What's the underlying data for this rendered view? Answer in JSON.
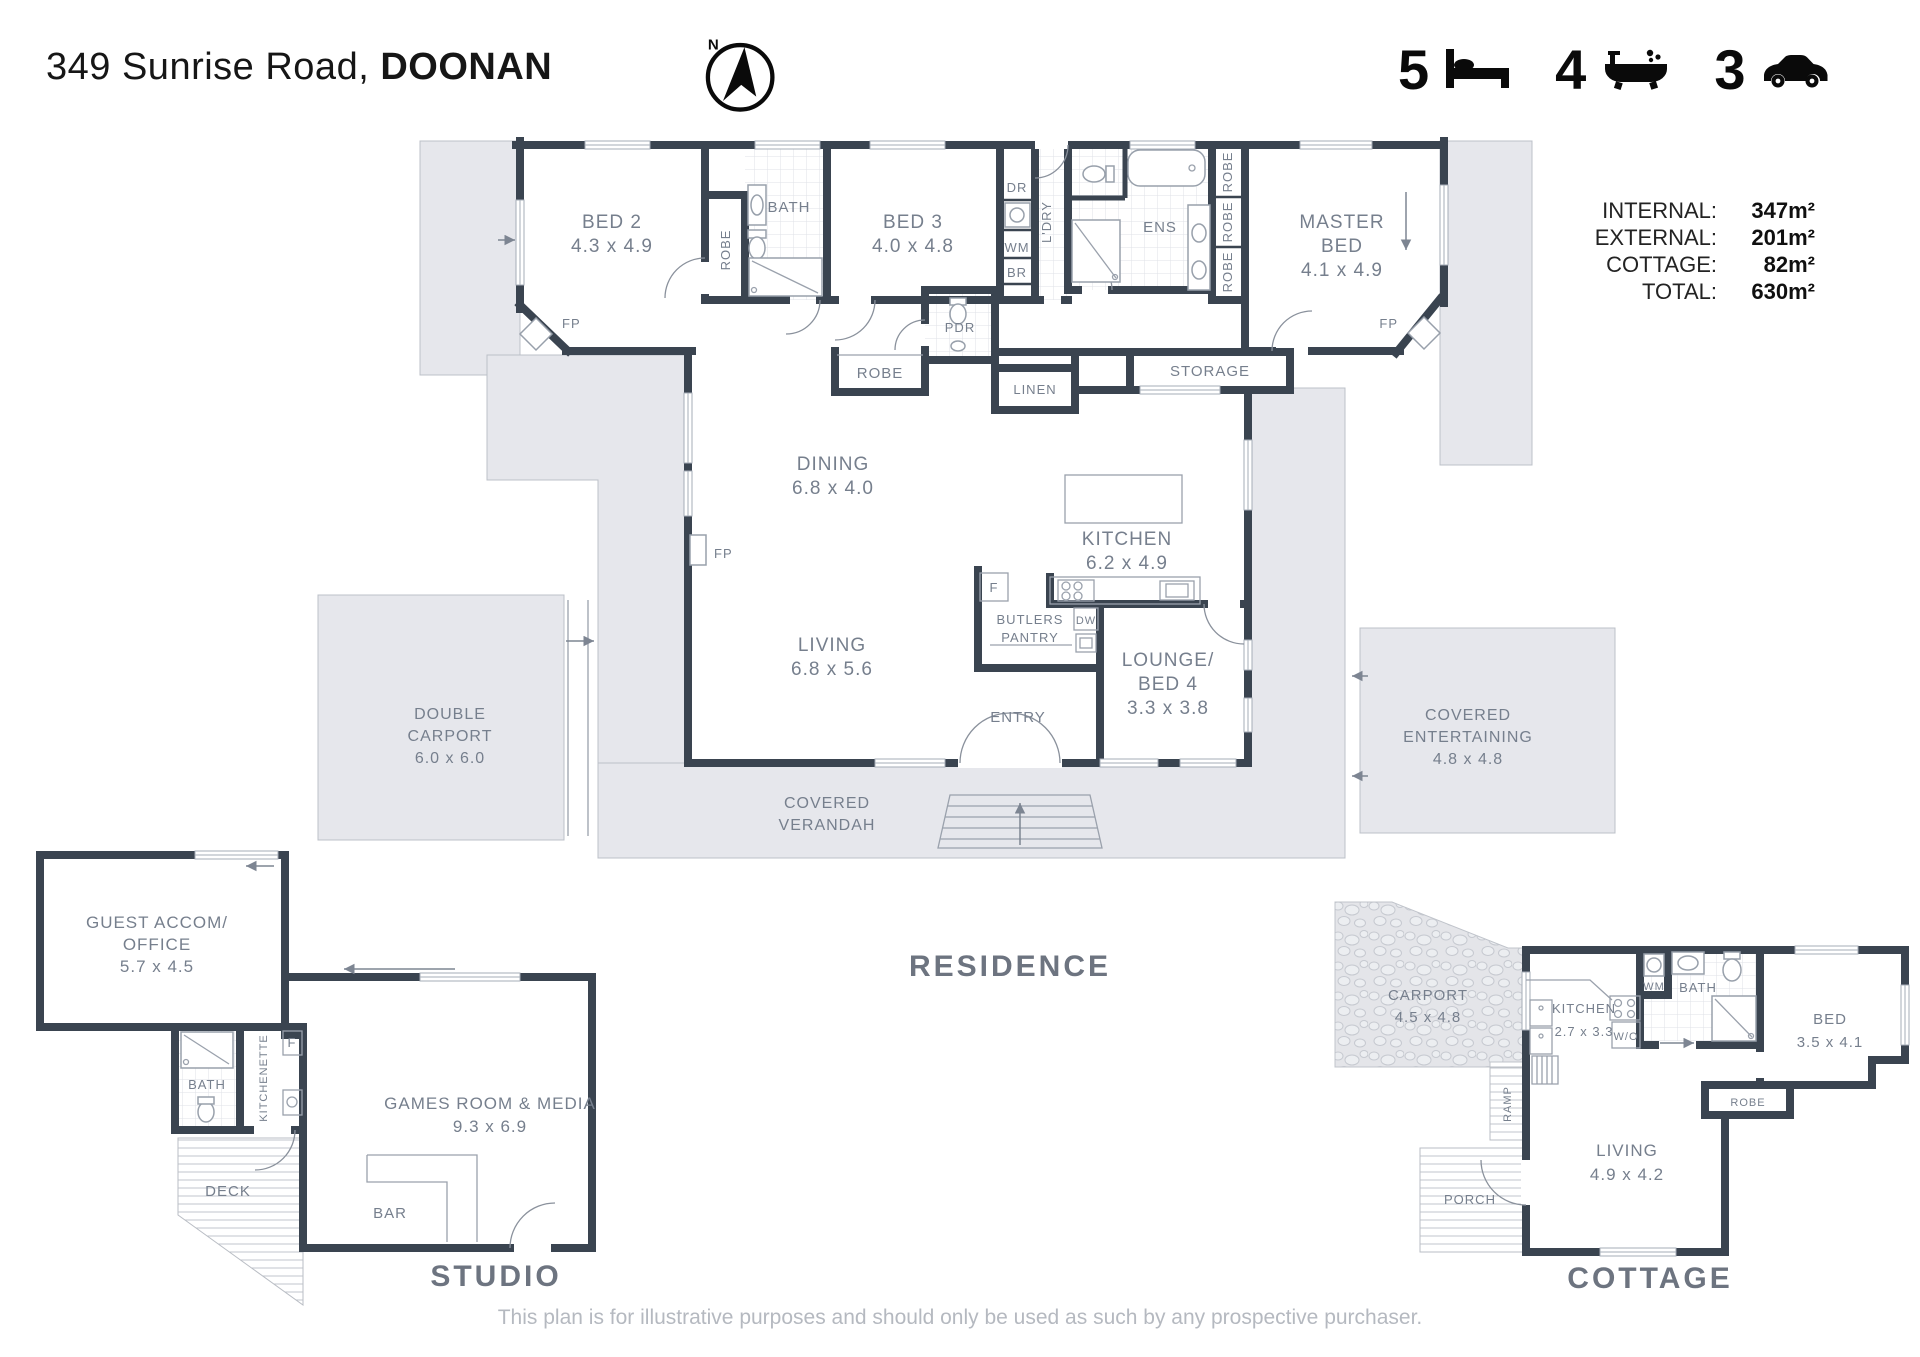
{
  "header": {
    "address_line": {
      "regular": "349 Sunrise Road, ",
      "bold": "DOONAN"
    },
    "compass_n": "N",
    "stats": {
      "beds": "5",
      "baths": "4",
      "cars": "3"
    },
    "areas": [
      {
        "label": "INTERNAL:",
        "value": "347m²"
      },
      {
        "label": "EXTERNAL:",
        "value": "201m²"
      },
      {
        "label": "COTTAGE:",
        "value": "82m²"
      },
      {
        "label": "TOTAL:",
        "value": "630m²"
      }
    ]
  },
  "residence": {
    "label": "RESIDENCE",
    "rooms": {
      "bed2": [
        "BED 2",
        "4.3 x 4.9"
      ],
      "bed3": [
        "BED 3",
        "4.0 x 4.8"
      ],
      "master": [
        "MASTER",
        "BED",
        "4.1 x 4.9"
      ],
      "dining": [
        "DINING",
        "6.8 x 4.0"
      ],
      "kitchen": [
        "KITCHEN",
        "6.2 x 4.9"
      ],
      "living": [
        "LIVING",
        "6.8 x 5.6"
      ],
      "lounge": [
        "LOUNGE/",
        "BED 4",
        "3.3 x 3.8"
      ],
      "butlers": [
        "BUTLERS",
        "PANTRY"
      ],
      "carport": [
        "DOUBLE",
        "CARPORT",
        "6.0 x 6.0"
      ],
      "entertaining": [
        "COVERED",
        "ENTERTAINING",
        "4.8 x 4.8"
      ],
      "verandah": [
        "COVERED",
        "VERANDAH"
      ]
    },
    "small": {
      "bath": "BATH",
      "robe": "ROBE",
      "ens": "ENS",
      "ldry": "L'DRY",
      "dr": "DR",
      "wm": "WM",
      "br": "BR",
      "pdr": "PDR",
      "linen": "LINEN",
      "storage": "STORAGE",
      "entry": "ENTRY",
      "fp": "FP",
      "f": "F",
      "dw": "DW"
    }
  },
  "studio": {
    "label": "STUDIO",
    "rooms": {
      "guest": [
        "GUEST ACCOM/",
        "OFFICE",
        "5.7 x 4.5"
      ],
      "games": [
        "GAMES ROOM & MEDIA",
        "9.3 x 6.9"
      ]
    },
    "small": {
      "bath": "BATH",
      "kitchenette": "KITCHENETTE",
      "f": "F",
      "deck": "DECK",
      "bar": "BAR"
    }
  },
  "cottage": {
    "label": "COTTAGE",
    "rooms": {
      "carport": [
        "CARPORT",
        "4.5 x 4.8"
      ],
      "kitchen": [
        "KITCHEN",
        "2.7 x 3.3"
      ],
      "bed": [
        "BED",
        "3.5 x 4.1"
      ],
      "living": [
        "LIVING",
        "4.9 x 4.2"
      ]
    },
    "small": {
      "wm": "WM",
      "bath": "BATH",
      "wo": "W/O",
      "robe": "ROBE",
      "ramp": "RAMP",
      "porch": "PORCH"
    }
  },
  "footer": {
    "disclaimer": "This plan is for illustrative purposes and should only be used as such by any prospective purchaser."
  }
}
